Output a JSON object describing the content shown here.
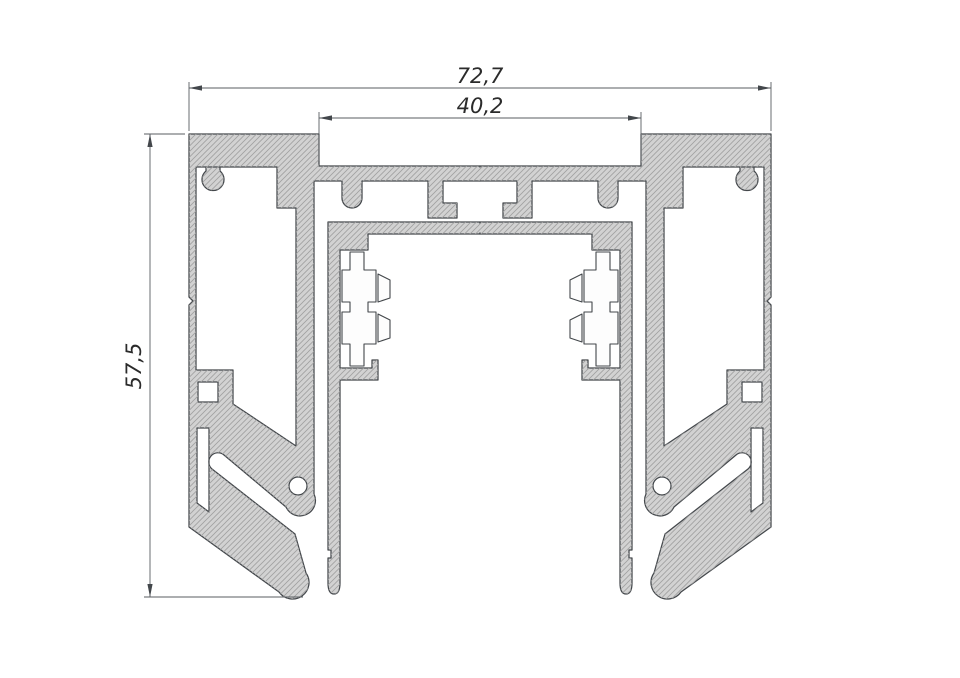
{
  "drawing": {
    "type": "technical-cross-section",
    "subject": "extruded-aluminium-profile",
    "dimensions": {
      "overall_width": "72,7",
      "inner_width": "40,2",
      "height": "57,5"
    },
    "colors": {
      "background": "#ffffff",
      "profile_fill": "#d2d2d2",
      "hatch_line": "#a0a0a0",
      "outline": "#43474b",
      "dimension_line": "#5a5e62",
      "dimension_text": "#2b2b2b"
    }
  }
}
